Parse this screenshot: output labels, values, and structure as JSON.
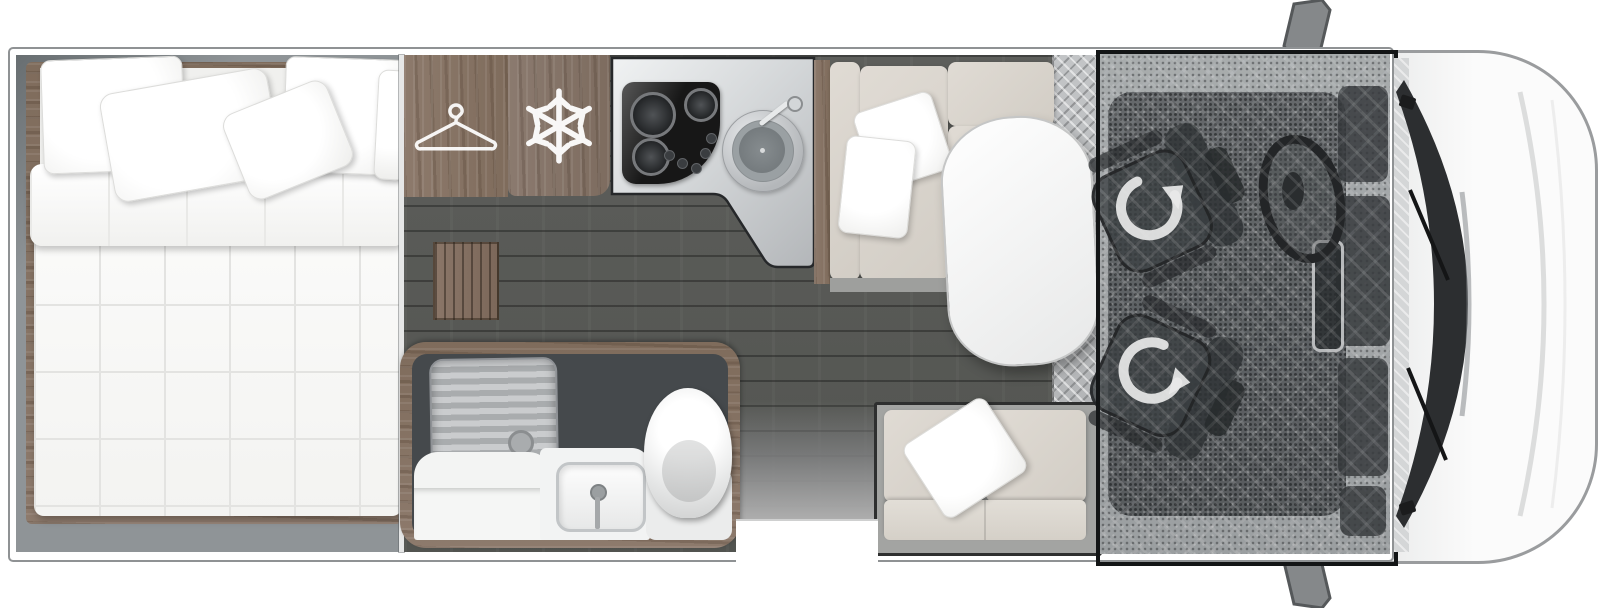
{
  "diagram": {
    "type": "motorhome-floor-plan",
    "view": "top-down, cab at right",
    "areas": [
      {
        "id": "bedroom",
        "label": "Bedroom with double bed and pillows"
      },
      {
        "id": "wardrobe",
        "label": "Wardrobe",
        "icon": "hanger-icon"
      },
      {
        "id": "fridge",
        "label": "Fridge freezer",
        "icon": "snowflake-icon"
      },
      {
        "id": "kitchen",
        "label": "Kitchen with hob and round sink"
      },
      {
        "id": "bathroom",
        "label": "Bathroom with shower tray, washbasin and toilet"
      },
      {
        "id": "dinette",
        "label": "L-shaped dinette seating with table"
      },
      {
        "id": "sofa",
        "label": "Rear sofa bench"
      },
      {
        "id": "entry",
        "label": "Entry step with door opening"
      },
      {
        "id": "cab",
        "label": "Driver cab with two swivel seats",
        "icon": "rotate-arrow-icon"
      },
      {
        "id": "front",
        "label": "Vehicle front with windscreen and wing mirrors"
      }
    ],
    "icons": [
      "hanger-icon",
      "snowflake-icon",
      "rotate-arrow-icon"
    ],
    "colors": {
      "wall_interior": "#8f9497",
      "wood_cabinet": "#8a7668",
      "floor_planks": "#57585a",
      "cushion_beige": "#d8d3cb",
      "counter_silver": "#d8dadc",
      "hob_black": "#171717",
      "bathroom_dark": "#45494c",
      "cab_outline": "#131516",
      "body_white": "#ffffff"
    }
  }
}
